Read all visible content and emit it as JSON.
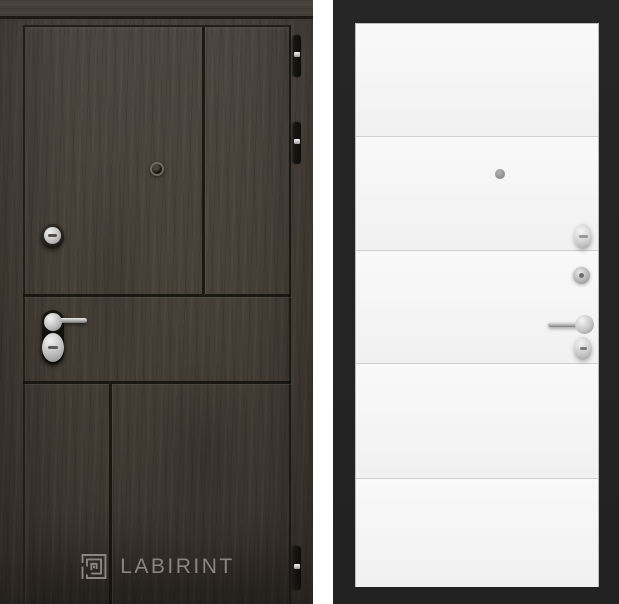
{
  "gallery": {
    "brand": "LABIRINT",
    "items": [
      {
        "id": "door-dark",
        "logo_text": "LABIRINT",
        "finish": "dark wenge wood entry door",
        "hardware": [
          "peephole",
          "deadbolt-lock",
          "lever-handle",
          "lock-cylinder",
          "hinges"
        ],
        "colors": {
          "wood": "#46403a",
          "groove": "#241f1b",
          "hinge": "#121110",
          "logo": "#8a857e"
        }
      },
      {
        "id": "door-white",
        "logo_text": "LABIRINT",
        "finish": "white interior panel with horizontal moldings",
        "hardware": [
          "peephole",
          "thumb-turn",
          "night-lock",
          "lever-handle",
          "lock-cylinder"
        ],
        "colors": {
          "frame": "#232323",
          "panel": "#f6f6f6",
          "panel_line": "#cfcfcf",
          "logo": "#d9d9d9"
        }
      }
    ]
  }
}
